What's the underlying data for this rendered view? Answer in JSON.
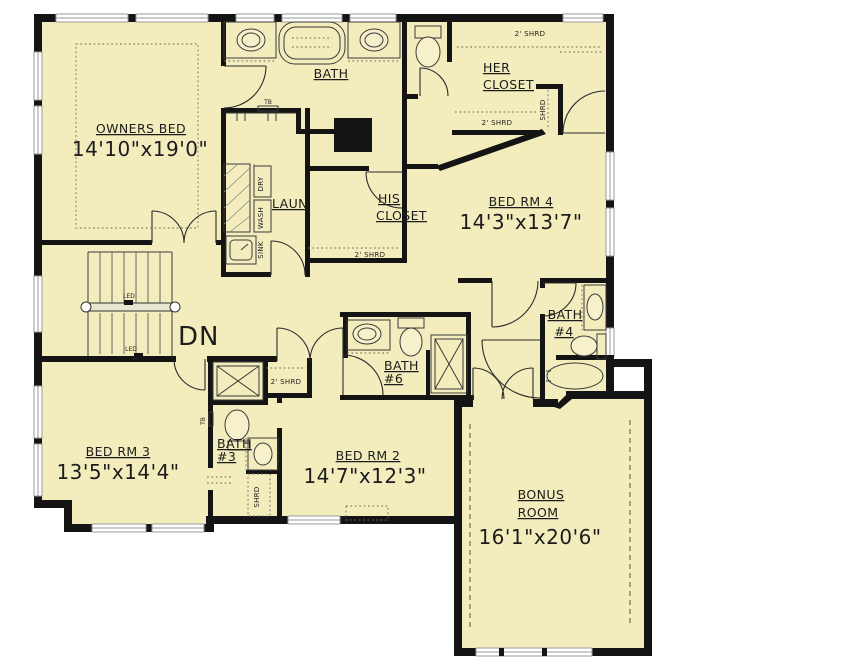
{
  "palette": {
    "floor": "#f3edbe",
    "wall": "#141414",
    "background": "#ffffff",
    "detail_line": "#3a3a3a"
  },
  "rooms": {
    "owners_bed": {
      "name": "OWNERS BED",
      "dims": "14'10\"x19'0\""
    },
    "bath": {
      "name": "BATH"
    },
    "her_closet": {
      "line1": "HER",
      "line2": "CLOSET"
    },
    "his_closet": {
      "line1": "HIS",
      "line2": "CLOSET"
    },
    "laundry": {
      "name": "LAUN"
    },
    "bed_rm_4": {
      "name": "BED RM 4",
      "dims": "14'3\"x13'7\""
    },
    "bed_rm_3": {
      "name": "BED RM 3",
      "dims": "13'5\"x14'4\""
    },
    "bed_rm_2": {
      "name": "BED RM 2",
      "dims": "14'7\"x12'3\""
    },
    "bonus_room": {
      "line1": "BONUS",
      "line2": "ROOM",
      "dims": "16'1\"x20'6\""
    },
    "bath_4": {
      "name": "BATH",
      "number": "#4"
    },
    "bath_3": {
      "name": "BATH",
      "number": "#3"
    },
    "bath_6": {
      "name": "BATH",
      "number": "#6"
    }
  },
  "annotations": {
    "stairs_direction": "DN",
    "ledge": "LED",
    "towel_bar": "TB",
    "sink": "SINK",
    "washer": "WASH",
    "dryer": "DRY",
    "shelf_rod": "SHRD",
    "shelf_rod_2ft": "2' SHRD"
  }
}
